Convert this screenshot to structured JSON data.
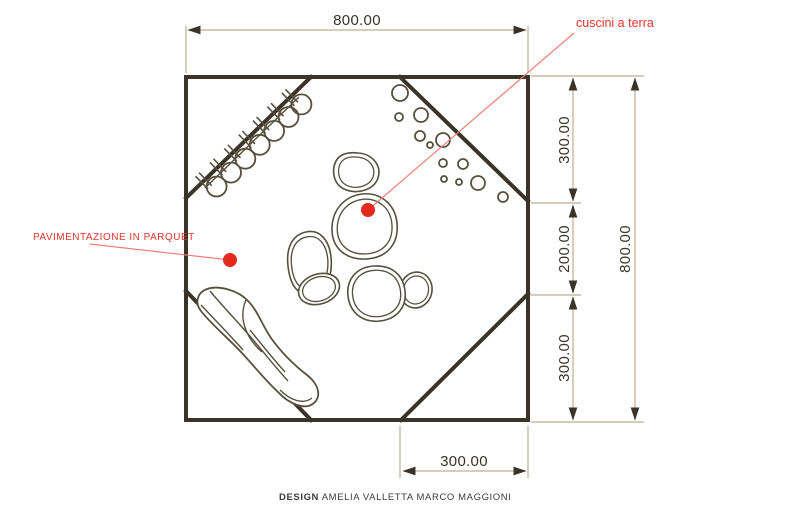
{
  "plan": {
    "dimensions": {
      "top_width": "800.00",
      "right_total": "800.00",
      "right_segments": [
        "300.00",
        "200.00",
        "300.00"
      ],
      "bottom_segment": "300.00"
    },
    "labels": {
      "cushions": "cuscini a terra",
      "flooring": "PAVIMENTAZIONE IN PARQUET"
    },
    "footer": {
      "role": "DESIGN",
      "names": " AMELIA VALLETTA  MARCO MAGGIONI"
    },
    "colors": {
      "wall": "#3a3428",
      "furniture": "#57503e",
      "dim-line": "#bcae90",
      "dim-text": "#3a3428",
      "red-label": "#e5352b",
      "red-leader": "#ee8078",
      "red-dot": "#e32a1e",
      "footer-text": "#3c3c3c",
      "background": "#ffffff"
    }
  }
}
